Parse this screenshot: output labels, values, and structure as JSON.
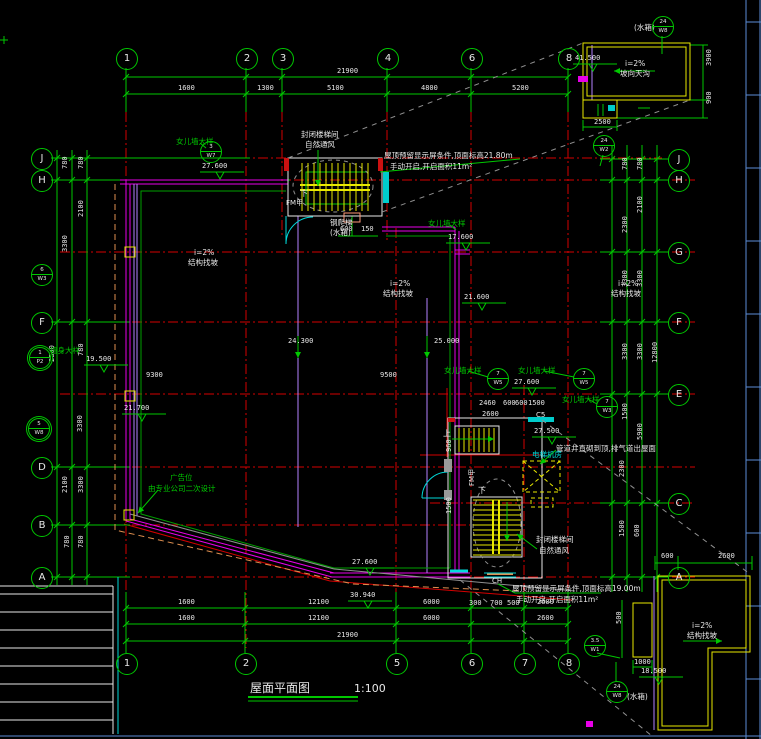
{
  "title": {
    "text": "屋面平面图",
    "scale": "1:100"
  },
  "colors": {
    "bg": "#000000",
    "green": "#00c800",
    "red": "#d40000",
    "magenta": "#e800e8",
    "yellow": "#e8e800",
    "cyan": "#00d8d8",
    "white": "#e8e8e8",
    "lavender": "#b482ff",
    "orange": "#e09050",
    "gray": "#909090",
    "frame_blue": "#5b8dd6"
  },
  "axis_bubbles": {
    "top": [
      {
        "label": "1",
        "x": 126
      },
      {
        "label": "2",
        "x": 246
      },
      {
        "label": "3",
        "x": 282
      },
      {
        "label": "4",
        "x": 387
      },
      {
        "label": "6",
        "x": 471
      },
      {
        "label": "8",
        "x": 568
      }
    ],
    "bottom": [
      {
        "label": "1",
        "x": 126
      },
      {
        "label": "2",
        "x": 245
      },
      {
        "label": "5",
        "x": 396
      },
      {
        "label": "6",
        "x": 471
      },
      {
        "label": "7",
        "x": 524
      },
      {
        "label": "8",
        "x": 568
      }
    ],
    "left": [
      {
        "label": "J",
        "y": 158,
        "ext": 250
      },
      {
        "label": "H",
        "y": 180,
        "ext": 290
      },
      {
        "label": "F",
        "y": 322
      },
      {
        "label": "D",
        "y": 467
      },
      {
        "label": "B",
        "y": 525
      },
      {
        "label": "A",
        "y": 577
      }
    ],
    "right": [
      {
        "label": "J",
        "y": 159
      },
      {
        "label": "H",
        "y": 180
      },
      {
        "label": "G",
        "y": 252
      },
      {
        "label": "F",
        "y": 322
      },
      {
        "label": "E",
        "y": 394
      },
      {
        "label": "C",
        "y": 503
      },
      {
        "label": "A",
        "y": 577
      }
    ]
  },
  "dimensions": [
    {
      "t": "21900",
      "x": 337,
      "y": 68
    },
    {
      "t": "1600",
      "x": 178,
      "y": 85
    },
    {
      "t": "1300",
      "x": 257,
      "y": 85
    },
    {
      "t": "5100",
      "x": 327,
      "y": 85
    },
    {
      "t": "4800",
      "x": 421,
      "y": 85
    },
    {
      "t": "5200",
      "x": 512,
      "y": 85
    },
    {
      "t": "1600",
      "x": 178,
      "y": 599
    },
    {
      "t": "12100",
      "x": 308,
      "y": 599
    },
    {
      "t": "6000",
      "x": 423,
      "y": 599
    },
    {
      "t": "300",
      "x": 469,
      "y": 600
    },
    {
      "t": "700",
      "x": 490,
      "y": 600
    },
    {
      "t": "500",
      "x": 507,
      "y": 600
    },
    {
      "t": "2600",
      "x": 537,
      "y": 599
    },
    {
      "t": "1600",
      "x": 178,
      "y": 615
    },
    {
      "t": "12100",
      "x": 308,
      "y": 615
    },
    {
      "t": "6000",
      "x": 423,
      "y": 615
    },
    {
      "t": "2600",
      "x": 537,
      "y": 615
    },
    {
      "t": "21900",
      "x": 337,
      "y": 632
    },
    {
      "t": "780",
      "x": 62,
      "y": 169,
      "r": 1
    },
    {
      "t": "780",
      "x": 78,
      "y": 169,
      "r": 1
    },
    {
      "t": "2100",
      "x": 78,
      "y": 217,
      "r": 1
    },
    {
      "t": "3300",
      "x": 62,
      "y": 252,
      "r": 1
    },
    {
      "t": "2800",
      "x": 49,
      "y": 362,
      "r": 1
    },
    {
      "t": "780",
      "x": 78,
      "y": 356,
      "r": 1
    },
    {
      "t": "3300",
      "x": 77,
      "y": 432,
      "r": 1
    },
    {
      "t": "2100",
      "x": 62,
      "y": 493,
      "r": 1
    },
    {
      "t": "3300",
      "x": 78,
      "y": 493,
      "r": 1
    },
    {
      "t": "780",
      "x": 64,
      "y": 548,
      "r": 1
    },
    {
      "t": "780",
      "x": 78,
      "y": 548,
      "r": 1
    },
    {
      "t": "780",
      "x": 622,
      "y": 170,
      "r": 1
    },
    {
      "t": "780",
      "x": 637,
      "y": 170,
      "r": 1
    },
    {
      "t": "2100",
      "x": 637,
      "y": 213,
      "r": 1
    },
    {
      "t": "2300",
      "x": 622,
      "y": 233,
      "r": 1
    },
    {
      "t": "3300",
      "x": 622,
      "y": 287,
      "r": 1
    },
    {
      "t": "3300",
      "x": 637,
      "y": 287,
      "r": 1
    },
    {
      "t": "3300",
      "x": 622,
      "y": 360,
      "r": 1
    },
    {
      "t": "3300",
      "x": 637,
      "y": 360,
      "r": 1
    },
    {
      "t": "12800",
      "x": 652,
      "y": 363,
      "r": 1
    },
    {
      "t": "1500",
      "x": 622,
      "y": 420,
      "r": 1
    },
    {
      "t": "5900",
      "x": 637,
      "y": 440,
      "r": 1
    },
    {
      "t": "2300",
      "x": 619,
      "y": 477,
      "r": 1
    },
    {
      "t": "1500",
      "x": 619,
      "y": 537,
      "r": 1
    },
    {
      "t": "600",
      "x": 634,
      "y": 537,
      "r": 1
    },
    {
      "t": "9300",
      "x": 146,
      "y": 372
    },
    {
      "t": "9500",
      "x": 380,
      "y": 372
    },
    {
      "t": "24.300",
      "x": 288,
      "y": 338
    },
    {
      "t": "25.000",
      "x": 434,
      "y": 338
    },
    {
      "t": "2460",
      "x": 479,
      "y": 400
    },
    {
      "t": "600",
      "x": 503,
      "y": 400
    },
    {
      "t": "600",
      "x": 515,
      "y": 400
    },
    {
      "t": "1500",
      "x": 528,
      "y": 400
    },
    {
      "t": "2600",
      "x": 482,
      "y": 411
    },
    {
      "t": "960",
      "x": 446,
      "y": 452,
      "r": 1
    },
    {
      "t": "1500",
      "x": 446,
      "y": 514,
      "r": 1
    },
    {
      "t": "600",
      "x": 340,
      "y": 226
    },
    {
      "t": "150",
      "x": 361,
      "y": 226
    },
    {
      "t": "2500",
      "x": 594,
      "y": 119
    },
    {
      "t": "3900",
      "x": 706,
      "y": 66,
      "r": 1
    },
    {
      "t": "900",
      "x": 706,
      "y": 104,
      "r": 1
    },
    {
      "t": "600",
      "x": 661,
      "y": 553
    },
    {
      "t": "2600",
      "x": 718,
      "y": 553
    },
    {
      "t": "1000",
      "x": 634,
      "y": 659
    },
    {
      "t": "500",
      "x": 616,
      "y": 624,
      "r": 1
    }
  ],
  "annotations": [
    {
      "t": "封闭楼梯间",
      "x": 301,
      "y": 131,
      "c": "w"
    },
    {
      "t": "自然通风",
      "x": 305,
      "y": 141,
      "c": "w"
    },
    {
      "t": "屋顶预留显示屏条件,顶面标高21.80m",
      "x": 384,
      "y": 152,
      "c": "w"
    },
    {
      "t": "手动开启,开启面积11m²",
      "x": 390,
      "y": 163,
      "c": "w"
    },
    {
      "t": "屋顶预留显示屏条件,顶面标高19.00m",
      "x": 512,
      "y": 585,
      "c": "w"
    },
    {
      "t": "手动开启,开启面积11m²",
      "x": 516,
      "y": 596,
      "c": "w"
    },
    {
      "t": "管道井直砌到顶,排气道出屋面",
      "x": 556,
      "y": 445,
      "c": "w"
    },
    {
      "t": "封闭楼梯间",
      "x": 536,
      "y": 536,
      "c": "w"
    },
    {
      "t": "自然通风",
      "x": 539,
      "y": 547,
      "c": "w"
    },
    {
      "t": "广告位",
      "x": 170,
      "y": 474,
      "c": "g"
    },
    {
      "t": "由专业公司二次设计",
      "x": 148,
      "y": 485,
      "c": "g"
    },
    {
      "t": "钢爬梯",
      "x": 330,
      "y": 219,
      "c": "w"
    },
    {
      "t": "(水箱)",
      "x": 330,
      "y": 229,
      "c": "w"
    },
    {
      "t": "女儿墙大样",
      "x": 176,
      "y": 138,
      "c": "g"
    },
    {
      "t": "女儿墙大样",
      "x": 428,
      "y": 220,
      "c": "g"
    },
    {
      "t": "女儿墙大样",
      "x": 444,
      "y": 367,
      "c": "g"
    },
    {
      "t": "女儿墙大样",
      "x": 518,
      "y": 367,
      "c": "g"
    },
    {
      "t": "女儿墙大样",
      "x": 562,
      "y": 396,
      "c": "g"
    },
    {
      "t": "墙身大样",
      "x": 50,
      "y": 347,
      "c": "g"
    },
    {
      "t": "(水箱)",
      "x": 634,
      "y": 24,
      "c": "w"
    },
    {
      "t": "(水箱)",
      "x": 627,
      "y": 693,
      "c": "w"
    },
    {
      "t": "i=2%",
      "x": 194,
      "y": 249,
      "c": "w"
    },
    {
      "t": "结构找坡",
      "x": 188,
      "y": 259,
      "c": "w"
    },
    {
      "t": "i=2%",
      "x": 390,
      "y": 280,
      "c": "w"
    },
    {
      "t": "结构找坡",
      "x": 383,
      "y": 290,
      "c": "w"
    },
    {
      "t": "i=2%",
      "x": 618,
      "y": 280,
      "c": "w"
    },
    {
      "t": "结构找坡",
      "x": 611,
      "y": 290,
      "c": "w"
    },
    {
      "t": "i=2%",
      "x": 692,
      "y": 622,
      "c": "w"
    },
    {
      "t": "结构找坡",
      "x": 687,
      "y": 632,
      "c": "w"
    },
    {
      "t": "i=2%",
      "x": 625,
      "y": 60,
      "c": "w"
    },
    {
      "t": "坡向天沟",
      "x": 620,
      "y": 70,
      "c": "w"
    },
    {
      "t": "电梯机房",
      "x": 532,
      "y": 451,
      "c": "c"
    }
  ],
  "plan_labels": [
    {
      "t": "下",
      "x": 300,
      "y": 190
    },
    {
      "t": "FM甲",
      "x": 286,
      "y": 200,
      "s": 7
    },
    {
      "t": "上",
      "x": 443,
      "y": 430
    },
    {
      "t": "下",
      "x": 478,
      "y": 487
    },
    {
      "t": "FM甲",
      "x": 469,
      "y": 486,
      "s": 7,
      "r": 1
    },
    {
      "t": "C5",
      "x": 536,
      "y": 412,
      "s": 7
    },
    {
      "t": "CH",
      "x": 492,
      "y": 578,
      "s": 7
    }
  ],
  "elevations": [
    {
      "v": "27.600",
      "x": 202,
      "y": 163
    },
    {
      "v": "19.500",
      "x": 86,
      "y": 356
    },
    {
      "v": "21.700",
      "x": 124,
      "y": 405
    },
    {
      "v": "17.600",
      "x": 448,
      "y": 234
    },
    {
      "v": "21.600",
      "x": 464,
      "y": 294
    },
    {
      "v": "27.600",
      "x": 514,
      "y": 379
    },
    {
      "v": "27.500",
      "x": 534,
      "y": 428
    },
    {
      "v": "27.600",
      "x": 352,
      "y": 559
    },
    {
      "v": "30.940",
      "x": 350,
      "y": 592
    },
    {
      "v": "18.500",
      "x": 641,
      "y": 668
    },
    {
      "v": "41.500",
      "x": 575,
      "y": 55
    }
  ],
  "detail_circles": [
    {
      "x": 210,
      "y": 151,
      "top": "3",
      "bot": "W7"
    },
    {
      "x": 41,
      "y": 274,
      "top": "6",
      "bot": "W3"
    },
    {
      "x": 39,
      "y": 357,
      "top": "1",
      "bot": "P2",
      "dbl": 1
    },
    {
      "x": 38,
      "y": 428,
      "top": "5",
      "bot": "W8",
      "dbl": 1
    },
    {
      "x": 497,
      "y": 378,
      "top": "7",
      "bot": "W5"
    },
    {
      "x": 583,
      "y": 378,
      "top": "7",
      "bot": "W5"
    },
    {
      "x": 606,
      "y": 406,
      "top": "7",
      "bot": "W3"
    },
    {
      "x": 662,
      "y": 26,
      "top": "24",
      "bot": "W8"
    },
    {
      "x": 616,
      "y": 691,
      "top": "24",
      "bot": "W8"
    },
    {
      "x": 594,
      "y": 645,
      "top": "3.5",
      "bot": "W1"
    },
    {
      "x": 603,
      "y": 145,
      "top": "24",
      "bot": "W2"
    }
  ]
}
